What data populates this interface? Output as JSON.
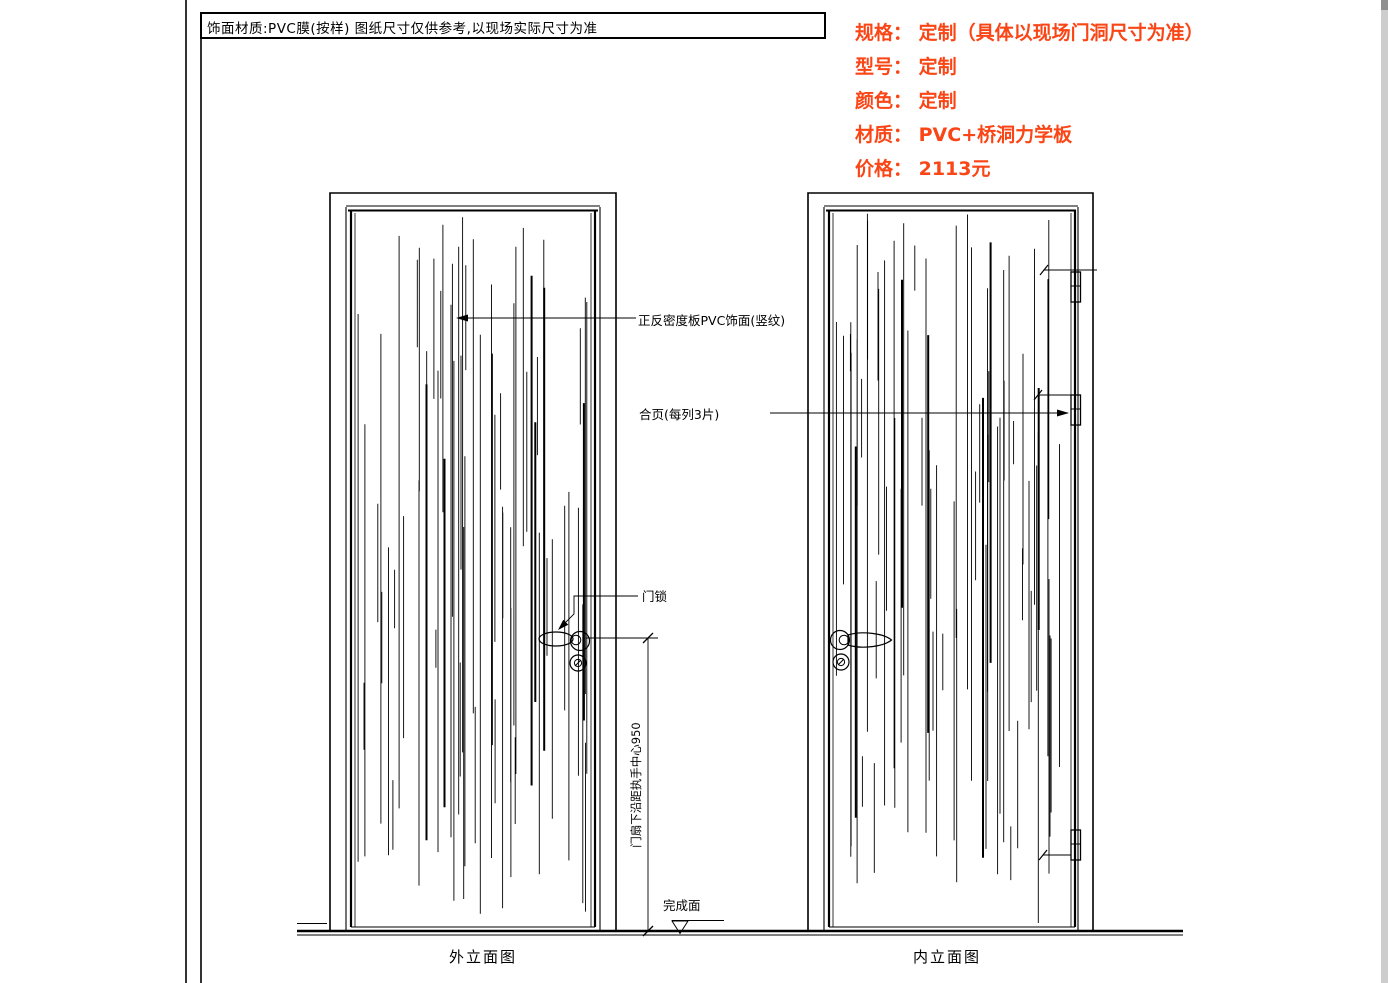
{
  "title_bar": {
    "note": "饰面材质:PVC膜(按样)  图纸尺寸仅供参考,以现场实际尺寸为准"
  },
  "specs": {
    "color": "#fa4616",
    "lines": [
      "规格： 定制（具体以现场门洞尺寸为准）",
      "型号： 定制",
      "颜色： 定制",
      "材质： PVC+桥洞力学板",
      "价格： 2113元"
    ]
  },
  "annotations": {
    "pvc_finish": "正反密度板PVC饰面(竖纹)",
    "hinge": "合页(每列3片)",
    "lock": "门锁",
    "handle_height_dim": "门扇下沿距执手中心950",
    "finish_surface": "完成面"
  },
  "elevation_labels": {
    "exterior": "外立面图",
    "interior": "内立面图"
  },
  "drawing": {
    "line_color": "#000000",
    "scrollbar_track_color": "#cdcdcd",
    "scrollbar_thumb_color": "#8f8f8f"
  }
}
